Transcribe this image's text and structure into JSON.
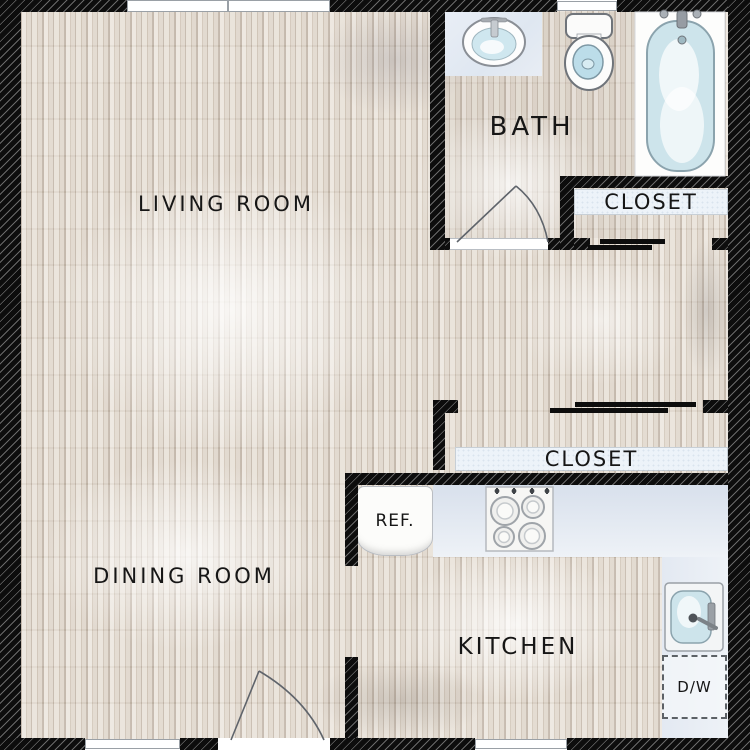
{
  "rooms": {
    "living": "LIVING ROOM",
    "dining": "DINING ROOM",
    "bath": "BATH",
    "kitchen": "KITCHEN"
  },
  "closets": {
    "upper": "CLOSET",
    "lower": "CLOSET"
  },
  "appliances": {
    "refrigerator": "REF.",
    "dishwasher": "D/W"
  },
  "fixtures": [
    "bathroom-sink",
    "toilet",
    "bathtub",
    "stove",
    "kitchen-sink",
    "refrigerator",
    "dishwasher"
  ],
  "colors": {
    "wall": "#0d0d0d",
    "floor": "#d6ccc0",
    "counter": "#dde4ee",
    "water": "#cde4eb",
    "label_band": "#edf3f9",
    "text": "#161616"
  }
}
